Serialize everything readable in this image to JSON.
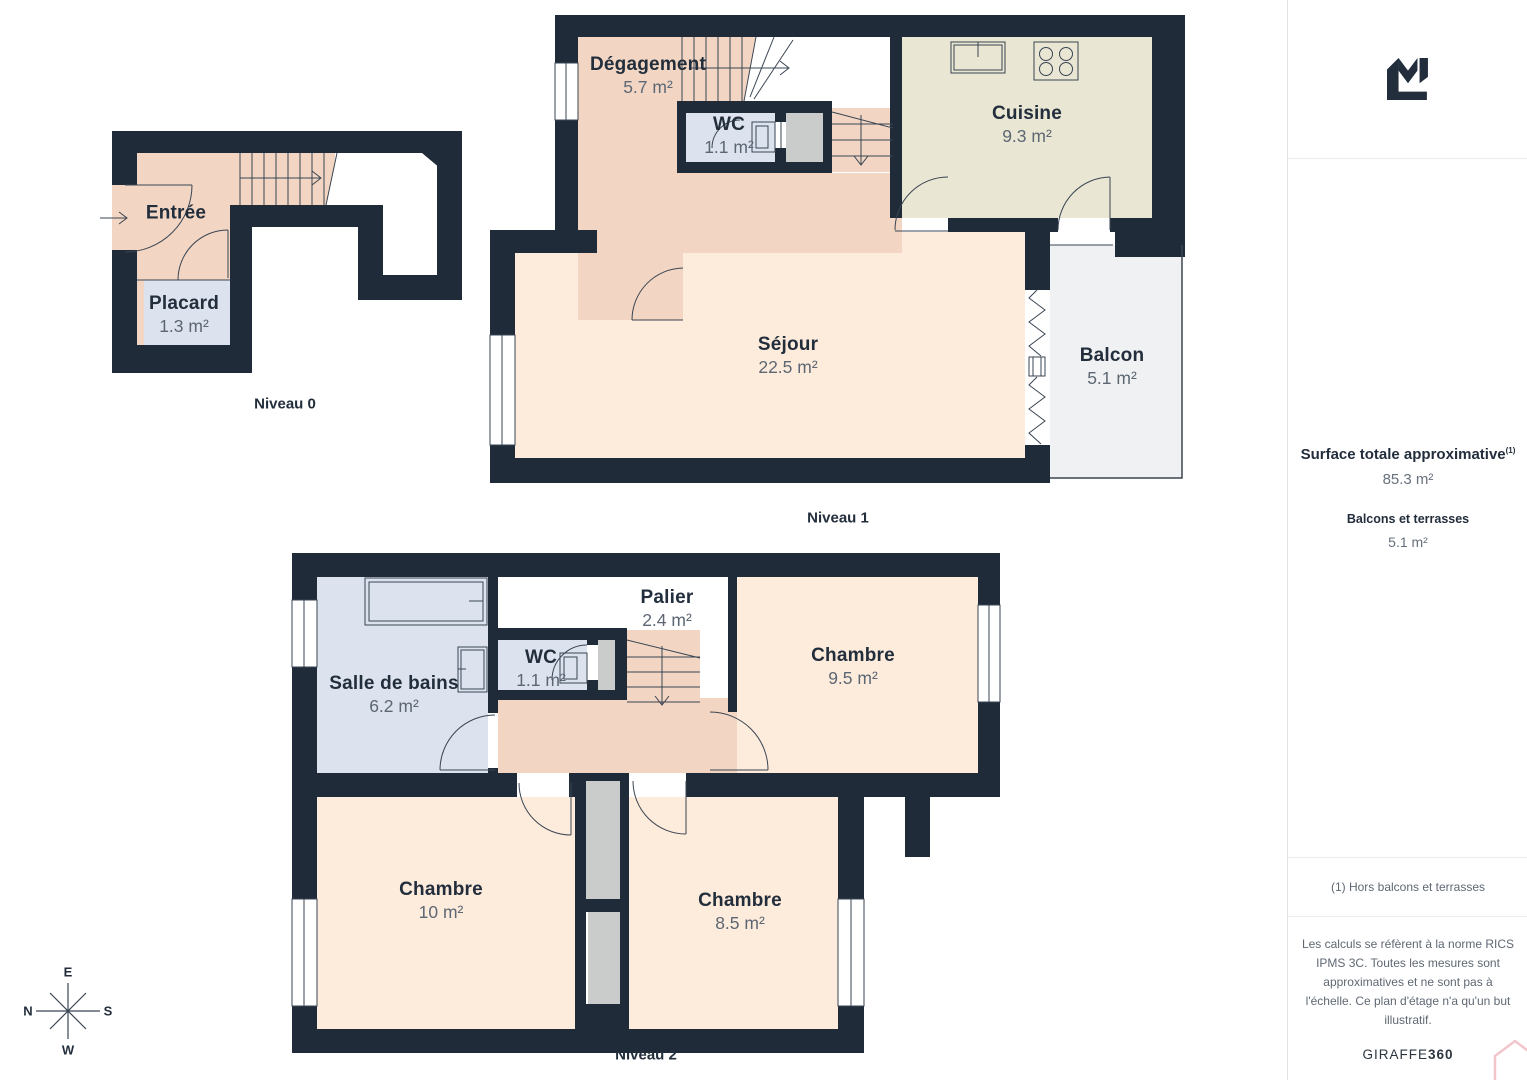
{
  "levels": [
    {
      "caption": "Niveau 0",
      "rooms": [
        {
          "name": "Entrée",
          "area": ""
        },
        {
          "name": "Placard",
          "area": "1.3 m²"
        }
      ]
    },
    {
      "caption": "Niveau 1",
      "rooms": [
        {
          "name": "Dégagement",
          "area": "5.7 m²"
        },
        {
          "name": "WC",
          "area": "1.1 m²"
        },
        {
          "name": "Cuisine",
          "area": "9.3 m²"
        },
        {
          "name": "Séjour",
          "area": "22.5 m²"
        },
        {
          "name": "Balcon",
          "area": "5.1 m²"
        }
      ]
    },
    {
      "caption": "Niveau 2",
      "rooms": [
        {
          "name": "Salle de bains",
          "area": "6.2 m²"
        },
        {
          "name": "WC",
          "area": "1.1 m²"
        },
        {
          "name": "Palier",
          "area": "2.4 m²"
        },
        {
          "name": "Chambre",
          "area": "9.5 m²"
        },
        {
          "name": "Chambre",
          "area": "10 m²"
        },
        {
          "name": "Chambre",
          "area": "8.5 m²"
        }
      ]
    }
  ],
  "sidebar": {
    "surface_title": "Surface totale approximative",
    "surface_title_sup": "(1)",
    "surface_value": "85.3 m²",
    "balconies_label": "Balcons et terrasses",
    "balconies_value": "5.1 m²",
    "footnote": "(1) Hors balcons et terrasses",
    "disclaimer": "Les calculs se réfèrent à la norme RICS IPMS 3C. Toutes les mesures sont approximatives et ne sont pas à l'échelle. Ce plan d'étage n'a qu'un but illustratif.",
    "brand_prefix": "GIRAFFE",
    "brand_suffix": "360"
  },
  "compass": {
    "top": "E",
    "left": "N",
    "right": "S",
    "bottom": "W"
  },
  "colors": {
    "wall": "#202b39",
    "floor_light": "#fdecdc",
    "floor_dark": "#f2d6c3",
    "kitchen": "#e9e6d3",
    "wet_room": "#dce3ef",
    "balcony": "#f0f1f2",
    "duct": "#c9cccb",
    "line": "#3a4553",
    "text": "#232e3c",
    "area_text": "#5d6774",
    "watermark_pink": "#f2c6cb"
  }
}
